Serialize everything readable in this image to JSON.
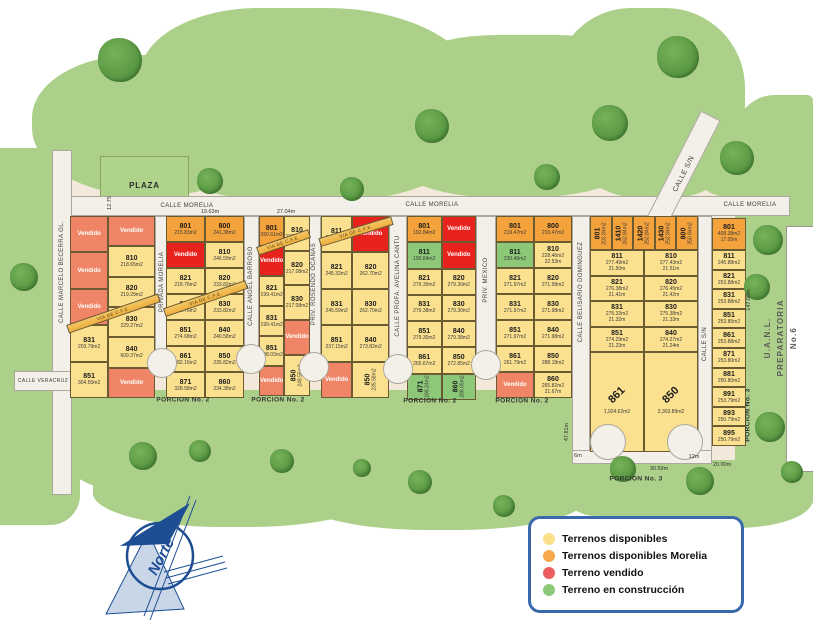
{
  "legend": {
    "items": [
      {
        "label": "Terrenos disponibles",
        "color": "#FBDF8B"
      },
      {
        "label": "Terrenos disponibles Morelia",
        "color": "#F5A94B"
      },
      {
        "label": "Terreno vendido",
        "color": "#EE5D5D"
      },
      {
        "label": "Terreno en construcción",
        "color": "#8CC87A"
      }
    ]
  },
  "compass": {
    "label": "Norte"
  },
  "streets": {
    "marcelo_becerra": "CALLE MARCELO BECERRA GL.",
    "veracruz": "CALLE VERACRUZ",
    "morelia": "CALLE MORELIA",
    "privada_morelia": "PRIVADA MORELIA",
    "angel_barroso": "CALLE ANGEL BARROSO",
    "rosendo_ocanas": "PRIV. ROSENDO OCANAS",
    "avelina_cantu": "CALLE PROFA. AVELINA CANTU",
    "priv_mexico": "PRIV. MEXICO",
    "belisario_dominguez": "CALLE BELISARIO DOMINGUEZ",
    "calle_sn": "CALLE S/N"
  },
  "areas": {
    "plaza": "PLAZA",
    "porcion2": "PORCION No. 2",
    "porcion3": "PORCION No. 3",
    "uanl_line1": "U.A.N.L.",
    "uanl_line2": "PREPARATORIA No.6",
    "via_cfe": "VIA DE C.F.E."
  },
  "measurements": {
    "plaza_side": "12.75",
    "b2_top": "19.63m",
    "b3_top": "27.04m",
    "b7_left": "47.81m",
    "right_side": "147.06m",
    "six": "6m",
    "twelve": "12m",
    "b7_bottom": "30.59m",
    "b8_bottom": "20.00m"
  },
  "blocks": {
    "b1": {
      "colA": [
        {
          "t": "Vendido",
          "s": "v2"
        },
        {
          "t": "Vendido",
          "s": "v2"
        },
        {
          "t": "Vendido",
          "s": "v2"
        },
        {
          "n": "831",
          "a": "203.79m2"
        },
        {
          "n": "851",
          "a": "304.50m2"
        }
      ],
      "colB": [
        {
          "t": "Vendido",
          "s": "v2"
        },
        {
          "n": "810",
          "a": "218.65m2"
        },
        {
          "n": "820",
          "a": "219.29m2"
        },
        {
          "n": "830",
          "a": "229.27m2"
        },
        {
          "n": "840",
          "a": "609.37m2"
        },
        {
          "t": "Vendido",
          "s": "v2"
        }
      ]
    },
    "b2": {
      "colA": [
        {
          "n": "801",
          "a": "215.83m2",
          "s": "m"
        },
        {
          "t": "Vendido",
          "s": "v"
        },
        {
          "n": "821",
          "a": "218.76m2"
        },
        {
          "n": "831",
          "a": "270.76m2"
        },
        {
          "n": "851",
          "a": "274.68m2"
        },
        {
          "n": "861",
          "a": "282.16m2"
        },
        {
          "n": "871",
          "a": "328.58m2"
        }
      ],
      "colB": [
        {
          "n": "800",
          "a": "241.38m2",
          "s": "m"
        },
        {
          "n": "810",
          "a": "246.59m2"
        },
        {
          "n": "820",
          "a": "233.82m2"
        },
        {
          "n": "830",
          "a": "233.82m2"
        },
        {
          "n": "840",
          "a": "240.58m2"
        },
        {
          "n": "850",
          "a": "235.82m2"
        },
        {
          "n": "860",
          "a": "234.38m2"
        }
      ]
    },
    "b3": {
      "colA": [
        {
          "n": "801",
          "a": "260.61m2",
          "s": "m"
        },
        {
          "t": "Vendido",
          "s": "v"
        },
        {
          "n": "821",
          "a": "199.41m2"
        },
        {
          "n": "831",
          "a": "199.41m2"
        },
        {
          "n": "851",
          "a": "198.03m2"
        },
        {
          "t": "Vendido",
          "s": "v2"
        }
      ],
      "colB": [
        {
          "n": "810",
          "a": "217.08m2"
        },
        {
          "n": "820",
          "a": "217.08m2"
        },
        {
          "n": "830",
          "a": "217.08m2"
        },
        {
          "t": "Vendido",
          "s": "v2"
        },
        {
          "n": "850",
          "a": "249.55m2",
          "r": "V",
          "f": 1.2
        }
      ]
    },
    "b4": {
      "colA": [
        {
          "n": "811",
          "a": "295.32m2"
        },
        {
          "n": "821",
          "a": "245.32m2"
        },
        {
          "n": "831",
          "a": "245.59m2"
        },
        {
          "n": "851",
          "a": "237.15m2"
        },
        {
          "t": "Vendido",
          "s": "v2"
        }
      ],
      "colB": [
        {
          "t": "Vendido",
          "s": "v"
        },
        {
          "n": "820",
          "a": "262.70m2"
        },
        {
          "n": "830",
          "a": "262.70m2"
        },
        {
          "n": "840",
          "a": "273.82m2"
        },
        {
          "n": "850",
          "a": "235.58m2",
          "r": "V"
        }
      ]
    },
    "b5": {
      "colA": [
        {
          "n": "801",
          "a": "192.84m2",
          "s": "m"
        },
        {
          "n": "811",
          "a": "190.84m2",
          "s": "c"
        },
        {
          "n": "821",
          "a": "279.30m2"
        },
        {
          "n": "831",
          "a": "279.38m2"
        },
        {
          "n": "851",
          "a": "279.30m2"
        },
        {
          "n": "861",
          "a": "265.67m2"
        },
        {
          "n": "871",
          "a": "188.24m2",
          "s": "c",
          "r": "V"
        }
      ],
      "colB": [
        {
          "t": "Vendido",
          "s": "v"
        },
        {
          "t": "Vendido",
          "s": "v"
        },
        {
          "n": "820",
          "a": "279.30m2"
        },
        {
          "n": "830",
          "a": "279.30m2"
        },
        {
          "n": "840",
          "a": "279.38m2"
        },
        {
          "n": "850",
          "a": "272.85m2"
        },
        {
          "n": "860",
          "a": "288.05m2",
          "s": "c",
          "r": "V"
        }
      ]
    },
    "b6": {
      "colA": [
        {
          "n": "801",
          "a": "219.47m2",
          "s": "m"
        },
        {
          "n": "811",
          "a": "230.46m2",
          "s": "c"
        },
        {
          "n": "821",
          "a": "271.97m2"
        },
        {
          "n": "831",
          "a": "271.97m2"
        },
        {
          "n": "851",
          "a": "271.97m2"
        },
        {
          "n": "861",
          "a": "261.79m2"
        },
        {
          "t": "Vendido",
          "s": "v2"
        }
      ],
      "colB": [
        {
          "n": "800",
          "a": "219.47m2",
          "s": "m"
        },
        {
          "n": "810",
          "a": "228.46m2",
          "d": "22.53m"
        },
        {
          "n": "820",
          "a": "271.98m2"
        },
        {
          "n": "830",
          "a": "271.98m2"
        },
        {
          "n": "840",
          "a": "271.98m2"
        },
        {
          "n": "850",
          "a": "288.18m2"
        },
        {
          "n": "860",
          "a": "265.82m2",
          "d": "21.67m"
        }
      ]
    },
    "b7": {
      "top": [
        {
          "n": "801",
          "a": "202.84m2",
          "s": "m",
          "r": "V"
        },
        {
          "n": "1410",
          "a": "262.84m2",
          "s": "m",
          "r": "V"
        },
        {
          "n": "1420",
          "a": "252.84m2",
          "s": "m",
          "r": "V"
        },
        {
          "n": "1430",
          "a": "252.84m2",
          "s": "m",
          "r": "V"
        },
        {
          "n": "800",
          "a": "250.84m2",
          "s": "m",
          "r": "V"
        }
      ],
      "colA": [
        {
          "n": "811",
          "a": "277.49m2",
          "d": "21.50m"
        },
        {
          "n": "821",
          "a": "276.38m2",
          "d": "21.41m"
        },
        {
          "n": "831",
          "a": "275.33m2",
          "d": "21.32m"
        },
        {
          "n": "851",
          "a": "274.29m2",
          "d": "21.23m"
        }
      ],
      "colB": [
        {
          "n": "810",
          "a": "277.43m2",
          "d": "21.51m"
        },
        {
          "n": "820",
          "a": "276.45m2",
          "d": "21.42m"
        },
        {
          "n": "830",
          "a": "275.38m2",
          "d": "21.33m"
        },
        {
          "n": "840",
          "a": "274.27m2",
          "d": "21.24m"
        }
      ],
      "big": [
        {
          "n": "861",
          "a": "1,924.62m2",
          "r": "D"
        },
        {
          "n": "850",
          "a": "2,303.89m2",
          "r": "D"
        }
      ]
    },
    "b8": {
      "col": [
        {
          "n": "801",
          "a": "408.38m2",
          "d": "17.05m",
          "s": "m",
          "f": 1.7
        },
        {
          "n": "811",
          "a": "245.88m2"
        },
        {
          "n": "821",
          "a": "253.88m2"
        },
        {
          "n": "831",
          "a": "253.88m2"
        },
        {
          "n": "851",
          "a": "253.85m2"
        },
        {
          "n": "861",
          "a": "253.88m2"
        },
        {
          "n": "871",
          "a": "253.80m2"
        },
        {
          "n": "881",
          "a": "250.80m2"
        },
        {
          "n": "891",
          "a": "253.79m2"
        },
        {
          "n": "893",
          "a": "250.79m2"
        },
        {
          "n": "895",
          "a": "250.79m2"
        }
      ]
    }
  }
}
